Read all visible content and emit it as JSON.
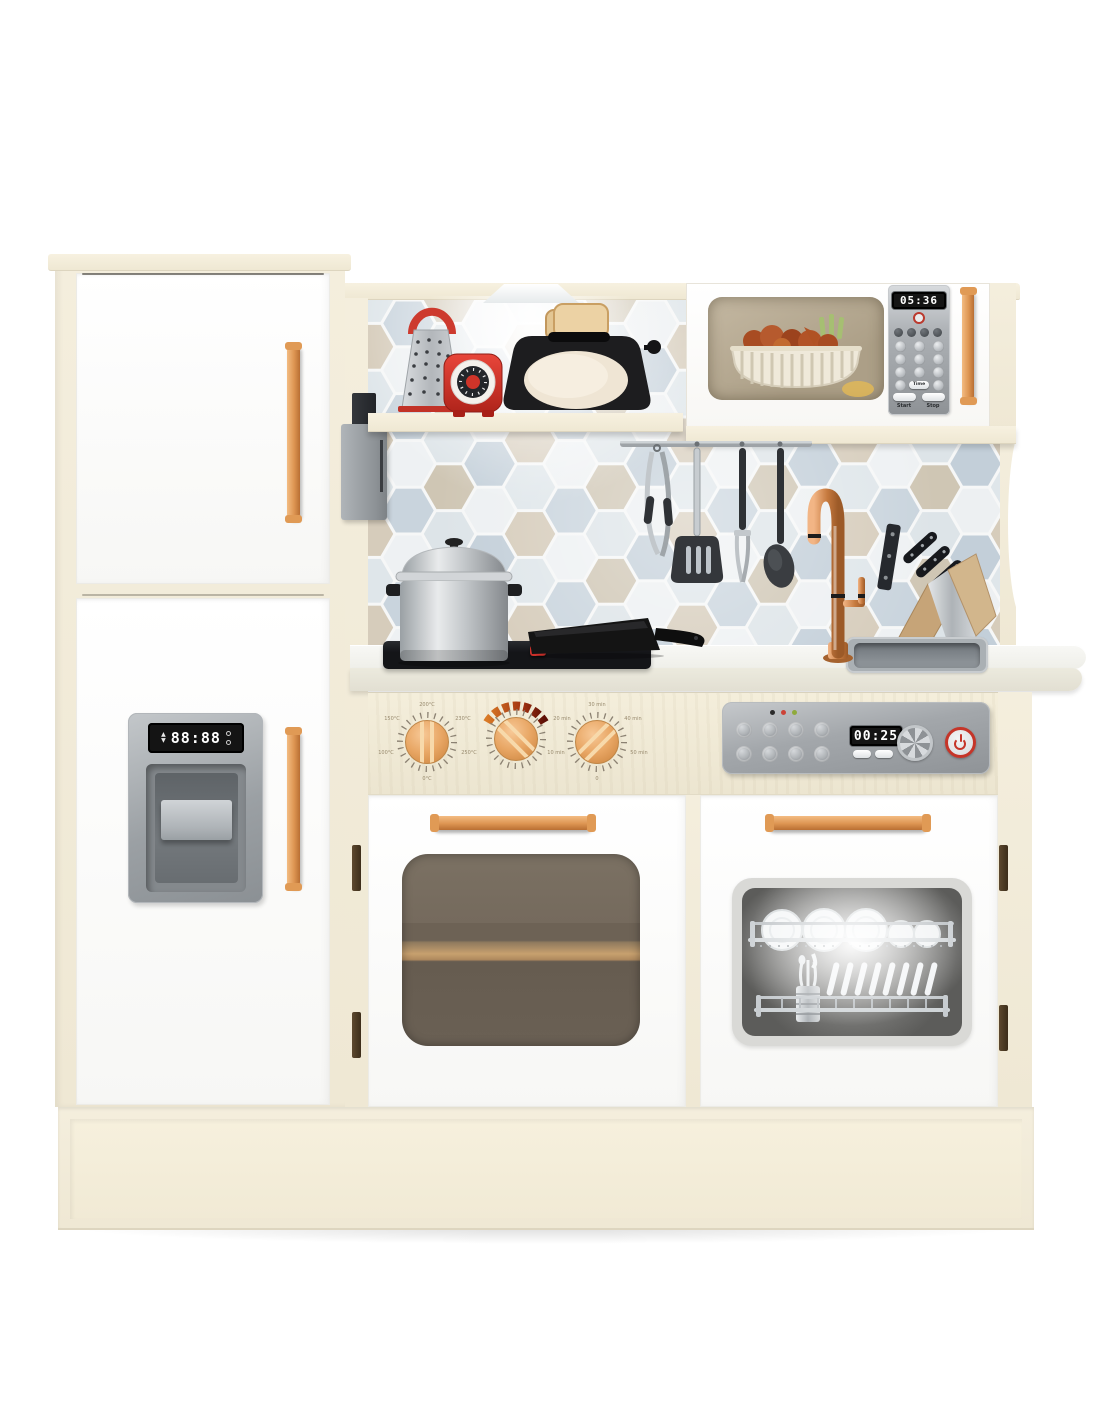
{
  "product": {
    "type": "wooden-toy-play-kitchen"
  },
  "colors": {
    "frame_cream": "#f1ead7",
    "door_white": "#fdfdfd",
    "handle_copper": "#dd9552",
    "accent_red": "#cf3b2f",
    "backsplash_blue": "#c9d4dd",
    "backsplash_beige": "#d6ccbb",
    "steel_grey": "#9aa0a5",
    "display_black": "#141414"
  },
  "fridge": {
    "ice_display": "88:88",
    "up_symbol": "▲",
    "down_symbol": "▼"
  },
  "microwave": {
    "display_time": "05:36",
    "start_label": "Start",
    "stop_label": "Stop",
    "time_label": "Time"
  },
  "dishwasher": {
    "display_time": "00:25",
    "power_icon": "power-symbol"
  },
  "controls": {
    "temp_labels": [
      "200°C",
      "230°C",
      "250°C",
      "0°C",
      "100°C",
      "150°C"
    ],
    "timer_labels": [
      "30 min",
      "40 min",
      "50 min",
      "0",
      "10 min",
      "20 min"
    ]
  }
}
